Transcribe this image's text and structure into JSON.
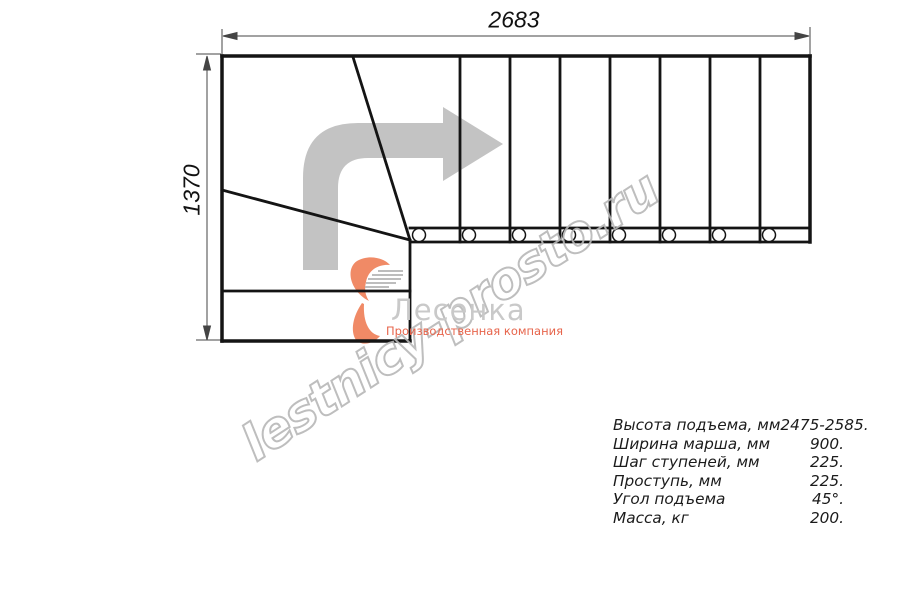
{
  "drawing": {
    "top_dimension": "2683",
    "left_dimension": "1370"
  },
  "watermark": {
    "text": "lestnicy-prosto.ru"
  },
  "logo": {
    "name": "Лесенка",
    "tagline": "Производственная компания"
  },
  "specs": {
    "rows": [
      {
        "label": "Высота подъема, мм",
        "value": "2475-2585."
      },
      {
        "label": "Ширина марша, мм",
        "value": "900."
      },
      {
        "label": "Шаг ступеней, мм",
        "value": "225."
      },
      {
        "label": "Проступь, мм",
        "value": "225."
      },
      {
        "label": "Угол подъема",
        "value": "45°."
      },
      {
        "label": "Масса, кг",
        "value": "200."
      }
    ]
  },
  "colors": {
    "plan_line": "#141414",
    "dimension_line": "#444444",
    "direction_arrow_gray": "#c3c3c3",
    "watermark_gray": "#b7b7b7",
    "logo_gray": "#c9c9c9",
    "logo_salmon": "#ef8763"
  }
}
